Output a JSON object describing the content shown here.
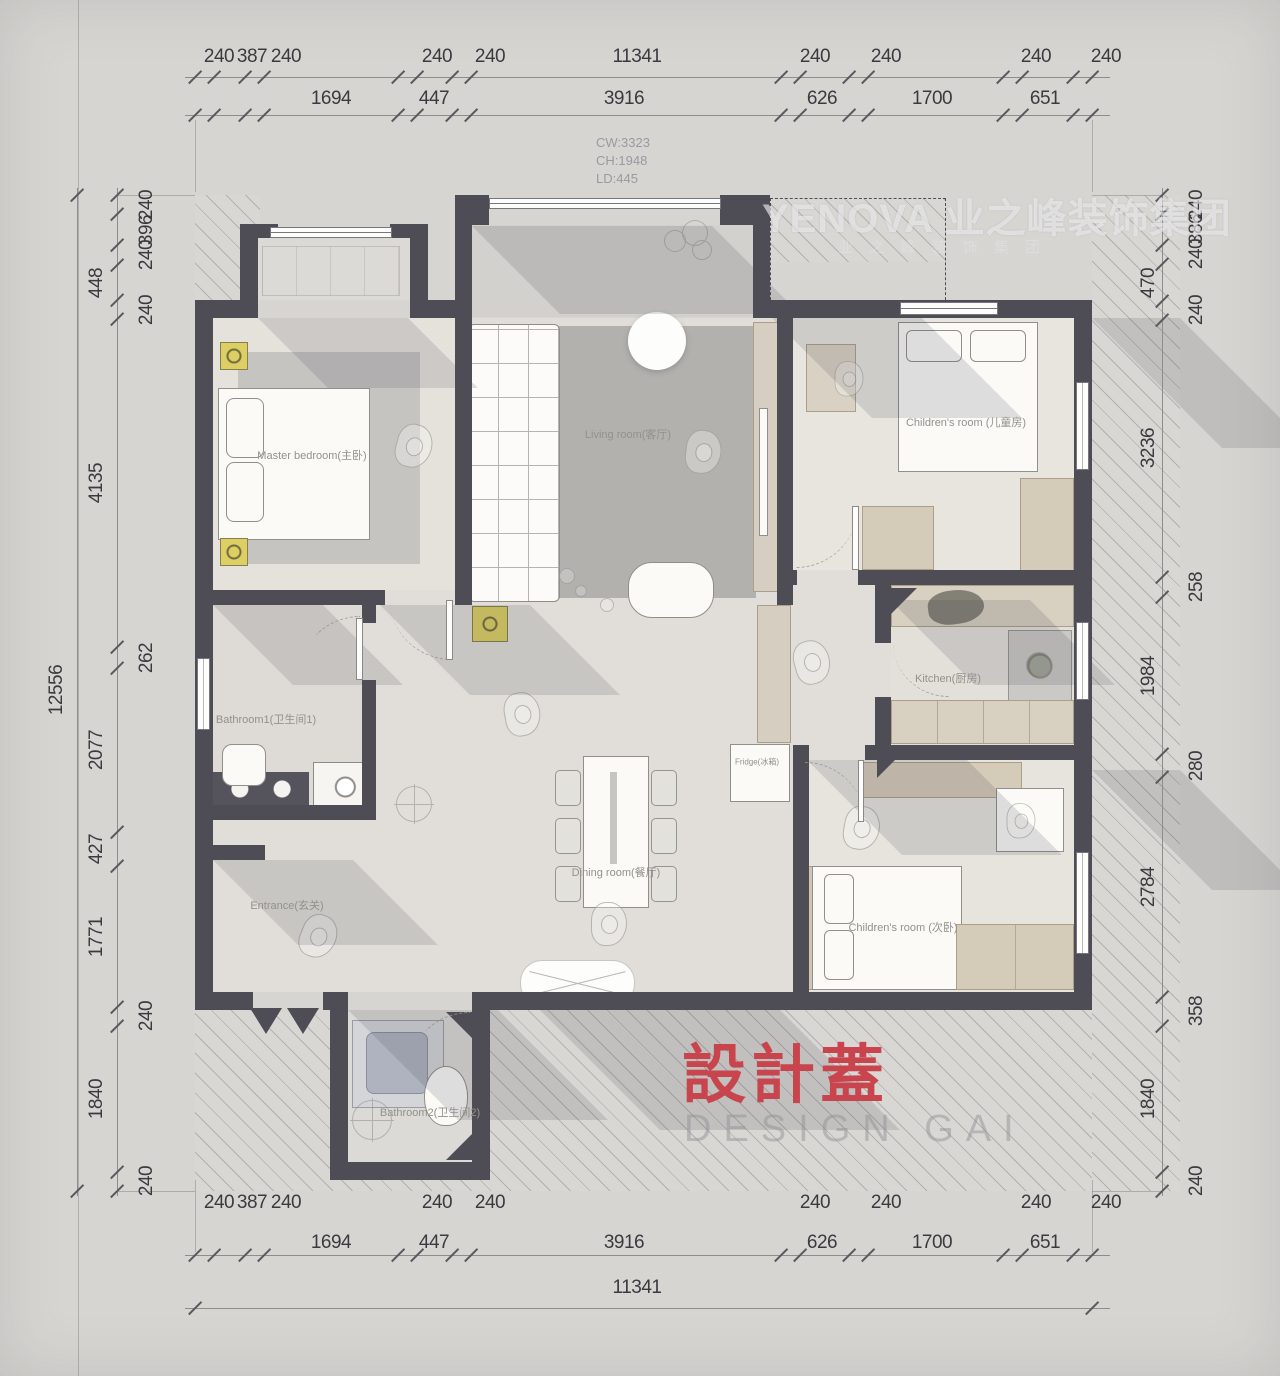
{
  "watermark": {
    "brand": "YENOVA 业之峰装饰集团",
    "sub": "业 之 峰 装 饰 集 团"
  },
  "stamp": {
    "cn": "設計蓋",
    "en": "DESIGN GAI"
  },
  "window_info": {
    "cw": "CW:3323",
    "ch": "CH:1948",
    "ld": "LD:445"
  },
  "plan": {
    "room_labels": [
      {
        "t": "Master bedroom(主卧)",
        "x": 312,
        "y": 455
      },
      {
        "t": "Living room(客厅)",
        "x": 628,
        "y": 434
      },
      {
        "t": "Children's room (儿童房)",
        "x": 966,
        "y": 422
      },
      {
        "t": "Kitchen(厨房)",
        "x": 948,
        "y": 678
      },
      {
        "t": "Bathroom1(卫生间1)",
        "x": 266,
        "y": 719
      },
      {
        "t": "Dining room(餐厅)",
        "x": 616,
        "y": 872
      },
      {
        "t": "Entrance(玄关)",
        "x": 287,
        "y": 905
      },
      {
        "t": "Children's room (次卧)",
        "x": 903,
        "y": 927
      },
      {
        "t": "Bathroom2(卫生间2)",
        "x": 430,
        "y": 1112
      },
      {
        "t": "Fridge(冰箱)",
        "x": 757,
        "y": 762,
        "s": 8
      }
    ]
  },
  "dimensions": {
    "labels": [
      {
        "t": "240",
        "x": 219,
        "y": 57
      },
      {
        "t": "387",
        "x": 252,
        "y": 57
      },
      {
        "t": "240",
        "x": 286,
        "y": 57
      },
      {
        "t": "240",
        "x": 437,
        "y": 57
      },
      {
        "t": "240",
        "x": 490,
        "y": 57
      },
      {
        "t": "11341",
        "x": 637,
        "y": 57
      },
      {
        "t": "240",
        "x": 815,
        "y": 57
      },
      {
        "t": "240",
        "x": 886,
        "y": 57
      },
      {
        "t": "240",
        "x": 1036,
        "y": 57
      },
      {
        "t": "240",
        "x": 1106,
        "y": 57
      },
      {
        "t": "1694",
        "x": 331,
        "y": 99
      },
      {
        "t": "447",
        "x": 434,
        "y": 99
      },
      {
        "t": "3916",
        "x": 624,
        "y": 99
      },
      {
        "t": "626",
        "x": 822,
        "y": 99
      },
      {
        "t": "1700",
        "x": 932,
        "y": 99
      },
      {
        "t": "651",
        "x": 1045,
        "y": 99
      },
      {
        "t": "240",
        "x": 219,
        "y": 1203
      },
      {
        "t": "387",
        "x": 252,
        "y": 1203
      },
      {
        "t": "240",
        "x": 286,
        "y": 1203
      },
      {
        "t": "240",
        "x": 437,
        "y": 1203
      },
      {
        "t": "240",
        "x": 490,
        "y": 1203
      },
      {
        "t": "240",
        "x": 815,
        "y": 1203
      },
      {
        "t": "240",
        "x": 886,
        "y": 1203
      },
      {
        "t": "240",
        "x": 1036,
        "y": 1203
      },
      {
        "t": "240",
        "x": 1106,
        "y": 1203
      },
      {
        "t": "1694",
        "x": 331,
        "y": 1243
      },
      {
        "t": "447",
        "x": 434,
        "y": 1243
      },
      {
        "t": "3916",
        "x": 624,
        "y": 1243
      },
      {
        "t": "626",
        "x": 822,
        "y": 1243
      },
      {
        "t": "1700",
        "x": 932,
        "y": 1243
      },
      {
        "t": "651",
        "x": 1045,
        "y": 1243
      },
      {
        "t": "11341",
        "x": 637,
        "y": 1288
      },
      {
        "t": "448",
        "x": 97,
        "y": 283,
        "r": 1
      },
      {
        "t": "4135",
        "x": 97,
        "y": 483,
        "r": 1
      },
      {
        "t": "2077",
        "x": 97,
        "y": 750,
        "r": 1
      },
      {
        "t": "427",
        "x": 97,
        "y": 849,
        "r": 1
      },
      {
        "t": "1771",
        "x": 97,
        "y": 937,
        "r": 1
      },
      {
        "t": "1840",
        "x": 97,
        "y": 1099,
        "r": 1
      },
      {
        "t": "240",
        "x": 147,
        "y": 205,
        "r": 1
      },
      {
        "t": "396",
        "x": 147,
        "y": 230,
        "r": 1
      },
      {
        "t": "240",
        "x": 147,
        "y": 255,
        "r": 1
      },
      {
        "t": "240",
        "x": 147,
        "y": 310,
        "r": 1
      },
      {
        "t": "262",
        "x": 147,
        "y": 658,
        "r": 1
      },
      {
        "t": "240",
        "x": 147,
        "y": 1016,
        "r": 1
      },
      {
        "t": "240",
        "x": 147,
        "y": 1181,
        "r": 1
      },
      {
        "t": "12556",
        "x": 57,
        "y": 690,
        "r": 1
      },
      {
        "t": "470",
        "x": 1149,
        "y": 283,
        "r": 1
      },
      {
        "t": "3236",
        "x": 1149,
        "y": 448,
        "r": 1
      },
      {
        "t": "1984",
        "x": 1149,
        "y": 676,
        "r": 1
      },
      {
        "t": "2784",
        "x": 1149,
        "y": 887,
        "r": 1
      },
      {
        "t": "1840",
        "x": 1149,
        "y": 1099,
        "r": 1
      },
      {
        "t": "240",
        "x": 1197,
        "y": 205,
        "r": 1
      },
      {
        "t": "386",
        "x": 1197,
        "y": 229,
        "r": 1
      },
      {
        "t": "240",
        "x": 1197,
        "y": 254,
        "r": 1
      },
      {
        "t": "240",
        "x": 1197,
        "y": 310,
        "r": 1
      },
      {
        "t": "258",
        "x": 1197,
        "y": 587,
        "r": 1
      },
      {
        "t": "280",
        "x": 1197,
        "y": 766,
        "r": 1
      },
      {
        "t": "358",
        "x": 1197,
        "y": 1011,
        "r": 1
      },
      {
        "t": "240",
        "x": 1197,
        "y": 1181,
        "r": 1
      }
    ],
    "tick_rows": [
      {
        "y": 77,
        "xs": [
          195,
          214,
          245,
          264,
          398,
          417,
          452,
          471,
          781,
          800,
          849,
          868,
          1003,
          1022,
          1073,
          1092
        ]
      },
      {
        "y": 115,
        "xs": [
          195,
          214,
          245,
          264,
          398,
          417,
          452,
          471,
          781,
          800,
          849,
          868,
          1003,
          1022,
          1073,
          1092
        ]
      },
      {
        "y": 1255,
        "xs": [
          195,
          214,
          245,
          264,
          398,
          417,
          452,
          471,
          781,
          800,
          849,
          868,
          1003,
          1022,
          1073,
          1092
        ]
      },
      {
        "y": 1308,
        "xs": [
          195,
          1092
        ]
      }
    ],
    "tick_cols": [
      {
        "x": 117,
        "ys": [
          195,
          214,
          245,
          265,
          300,
          319,
          647,
          668,
          832,
          866,
          1007,
          1026,
          1172,
          1191
        ]
      },
      {
        "x": 77,
        "ys": [
          195,
          1191
        ]
      },
      {
        "x": 1162,
        "ys": [
          195,
          214,
          245,
          264,
          301,
          320,
          577,
          597,
          754,
          777,
          997,
          1026,
          1172,
          1191
        ]
      }
    ]
  }
}
